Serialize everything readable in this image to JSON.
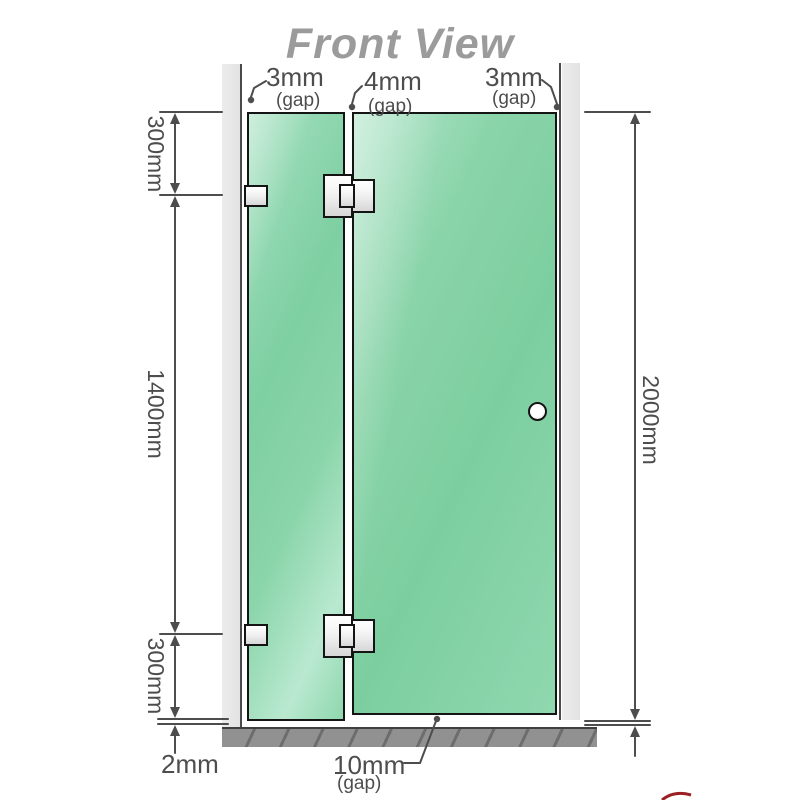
{
  "title": "Front View",
  "colors": {
    "glass_green": "#7ecfa2",
    "glass_highlight": "#b9e9d0",
    "frame_black": "#141414",
    "wall_gray": "#e7e7e7",
    "base_gray": "#919191",
    "dimension_gray": "#4d4d4d",
    "title_gray": "#9b9b9b",
    "logo_red": "#9c1f24"
  },
  "labels": {
    "top_gaps": [
      {
        "value": "3mm",
        "qualifier": "(gap)"
      },
      {
        "value": "4mm",
        "qualifier": "(gap)"
      },
      {
        "value": "3mm",
        "qualifier": "(gap)"
      }
    ],
    "left_segments": [
      "300mm",
      "1400mm",
      "300mm"
    ],
    "floor_clearance": "2mm",
    "total_height": "2000mm",
    "bottom_gap": {
      "value": "10mm",
      "qualifier": "(gap)"
    }
  }
}
